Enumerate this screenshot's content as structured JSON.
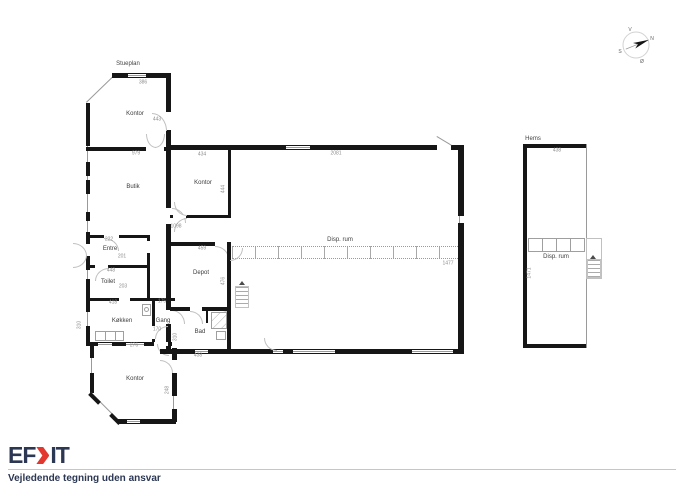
{
  "plan": {
    "floor_title": "Stueplan",
    "loft_title": "Hems",
    "rooms": {
      "kontor_top": "Kontor",
      "butik": "Butik",
      "kontor_mid": "Kontor",
      "entre": "Entre",
      "toilet": "Toilet",
      "koekken": "Køkken",
      "gang": "Gang",
      "depot": "Depot",
      "bad": "Bad",
      "kontor_bottom": "Kontor",
      "disp_rum_hall": "Disp. rum",
      "disp_rum_hems": "Disp. rum"
    },
    "compass": {
      "north": "N",
      "east": "Ø",
      "south": "S",
      "west": "V"
    },
    "dimensions": [
      {
        "text": "386",
        "x": 143,
        "y": 83
      },
      {
        "text": "443",
        "x": 157,
        "y": 120
      },
      {
        "text": "979",
        "x": 136,
        "y": 154
      },
      {
        "text": "434",
        "x": 202,
        "y": 155
      },
      {
        "text": "444",
        "x": 224,
        "y": 189,
        "v": true
      },
      {
        "text": "2081",
        "x": 336,
        "y": 154
      },
      {
        "text": "1098",
        "x": 176,
        "y": 227
      },
      {
        "text": "459",
        "x": 202,
        "y": 249
      },
      {
        "text": "476",
        "x": 224,
        "y": 281,
        "v": true
      },
      {
        "text": "222",
        "x": 109,
        "y": 240
      },
      {
        "text": "201",
        "x": 122,
        "y": 257
      },
      {
        "text": "448",
        "x": 111,
        "y": 271
      },
      {
        "text": "203",
        "x": 123,
        "y": 287
      },
      {
        "text": "418",
        "x": 113,
        "y": 303
      },
      {
        "text": "175",
        "x": 162,
        "y": 302
      },
      {
        "text": "170",
        "x": 157,
        "y": 330
      },
      {
        "text": "310",
        "x": 80,
        "y": 325,
        "v": true
      },
      {
        "text": "310",
        "x": 176,
        "y": 337,
        "v": true
      },
      {
        "text": "438",
        "x": 198,
        "y": 356
      },
      {
        "text": "276",
        "x": 134,
        "y": 346
      },
      {
        "text": "248",
        "x": 168,
        "y": 390,
        "v": true
      },
      {
        "text": "1477",
        "x": 448,
        "y": 264
      },
      {
        "text": "438",
        "x": 557,
        "y": 151
      },
      {
        "text": "1471",
        "x": 530,
        "y": 273,
        "v": true
      }
    ]
  },
  "footer": {
    "logo_prefix": "EF",
    "logo_suffix": "IT",
    "disclaimer": "Vejledende tegning uden ansvar"
  },
  "colors": {
    "wall": "#161616",
    "thin_line": "#9a9a9a",
    "logo_navy": "#2b3753",
    "logo_red": "#e2372f"
  }
}
